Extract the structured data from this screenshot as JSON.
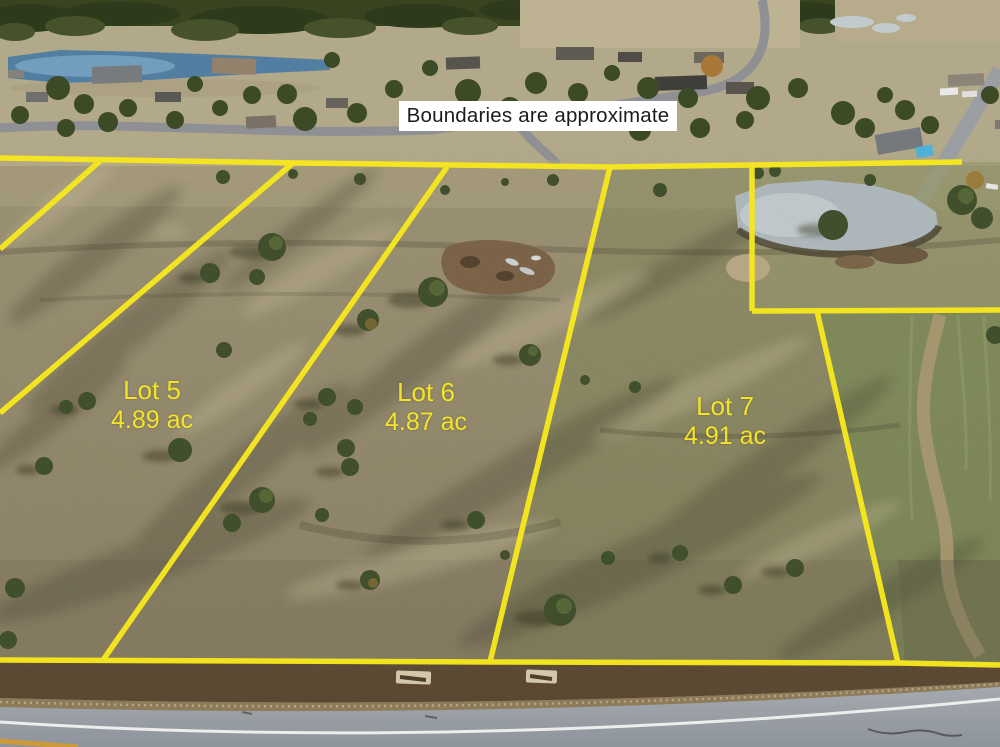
{
  "banner": {
    "text": "Boundaries are approximate"
  },
  "lots": [
    {
      "name": "Lot 5",
      "area": "4.89 ac"
    },
    {
      "name": "Lot 6",
      "area": "4.87 ac"
    },
    {
      "name": "Lot 7",
      "area": "4.91 ac"
    }
  ],
  "colors": {
    "boundary_line": "#f6e71e",
    "lot_label": "#f3e42b",
    "banner_bg": "#ffffff",
    "banner_text": "#1c1c1e"
  }
}
